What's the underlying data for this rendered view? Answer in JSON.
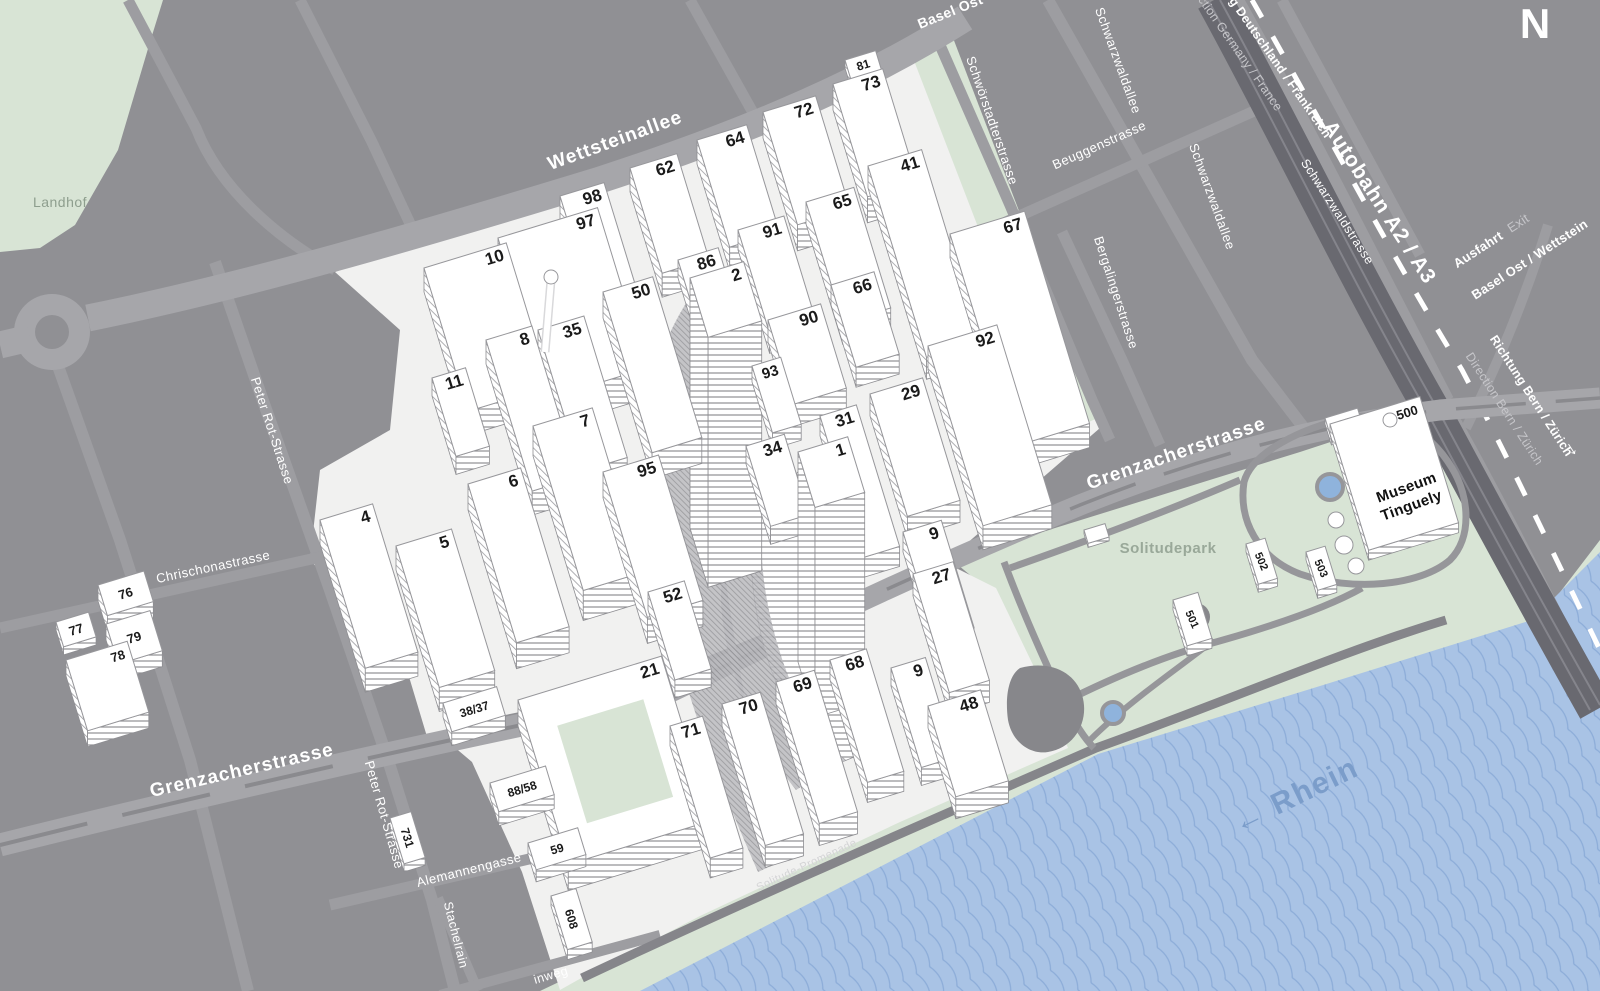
{
  "map": {
    "colors": {
      "background": "#909094",
      "road_major": "#a6a6aa",
      "road_minor": "#9d9da1",
      "road_median": "#8a8a8e",
      "autobahn": "#696970",
      "campus_ground": "#f1f1f0",
      "green_area": "#d8e4d5",
      "water": "#a9c3e5",
      "water_line": "#8cacd8",
      "water_label": "#7b9dca",
      "building_fill": "#ffffff",
      "building_edge": "#97979b",
      "building_number": "#1a1a1a",
      "street_label": "#ffffff",
      "muted_label": "#c6c6ca",
      "park_label": "#99a899",
      "park_path": "#96969a"
    },
    "compass": {
      "label": "N"
    },
    "street_labels": [
      {
        "text": "Wettsteinallee",
        "x": 617,
        "y": 146,
        "rot": -20,
        "size": 19,
        "color": "#ffffff",
        "weight": 600,
        "spacing": 1
      },
      {
        "text": "Grenzacherstrasse",
        "x": 243,
        "y": 776,
        "rot": -13,
        "size": 19,
        "color": "#ffffff",
        "weight": 600,
        "spacing": 1
      },
      {
        "text": "Grenzacherstrasse",
        "x": 1178,
        "y": 459,
        "rot": -19,
        "size": 19,
        "color": "#ffffff",
        "weight": 600,
        "spacing": 1
      },
      {
        "text": "Chrischonastrasse",
        "x": 214,
        "y": 571,
        "rot": -12,
        "size": 13,
        "color": "#ffffff",
        "weight": 400,
        "spacing": 0.5
      },
      {
        "text": "Peter Rot-Strasse",
        "x": 268,
        "y": 432,
        "rot": 72,
        "size": 13,
        "color": "#ffffff",
        "weight": 400,
        "spacing": 0.5
      },
      {
        "text": "Peter Rot-Strasse",
        "x": 380,
        "y": 816,
        "rot": 74,
        "size": 13,
        "color": "#ffffff",
        "weight": 400,
        "spacing": 0.5
      },
      {
        "text": "Alemannengasse",
        "x": 470,
        "y": 874,
        "rot": -14,
        "size": 13,
        "color": "#ffffff",
        "weight": 400,
        "spacing": 0.5
      },
      {
        "text": "Stachelrain",
        "x": 452,
        "y": 936,
        "rot": 76,
        "size": 12.5,
        "color": "#ffffff",
        "weight": 400,
        "spacing": 0.5
      },
      {
        "text": "inweg",
        "x": 552,
        "y": 979,
        "rot": -16,
        "size": 12.5,
        "color": "#ffffff",
        "weight": 400,
        "spacing": 0.5
      },
      {
        "text": "Schwörstadterstrasse",
        "x": 988,
        "y": 122,
        "rot": 71,
        "size": 13,
        "color": "#ffffff",
        "weight": 400,
        "spacing": 0.5
      },
      {
        "text": "Schwarzwaldallee",
        "x": 1114,
        "y": 62,
        "rot": 70,
        "size": 13,
        "color": "#ffffff",
        "weight": 400,
        "spacing": 0.5
      },
      {
        "text": "Schwarzwaldallee",
        "x": 1208,
        "y": 198,
        "rot": 70,
        "size": 13,
        "color": "#ffffff",
        "weight": 400,
        "spacing": 0.5
      },
      {
        "text": "Beuggenstrasse",
        "x": 1101,
        "y": 149,
        "rot": -24,
        "size": 13,
        "color": "#ffffff",
        "weight": 400,
        "spacing": 0.5
      },
      {
        "text": "Bergalingerstrasse",
        "x": 1112,
        "y": 294,
        "rot": 72,
        "size": 13,
        "color": "#ffffff",
        "weight": 400,
        "spacing": 0.5
      },
      {
        "text": "Schwarzwaldstrasse",
        "x": 1334,
        "y": 214,
        "rot": 57,
        "size": 12.5,
        "color": "#ffffff",
        "weight": 400,
        "spacing": 0.5
      },
      {
        "text": "Solitude-Promenade",
        "x": 808,
        "y": 868,
        "rot": -25,
        "size": 11,
        "color": "#d4d4d6",
        "weight": 400,
        "spacing": 0.5
      }
    ],
    "highway_labels": [
      {
        "text": "Autobahn A2 / A3",
        "x": 1374,
        "y": 206,
        "rot": 57,
        "size": 21,
        "color": "#ffffff",
        "weight": 600,
        "spacing": 1
      },
      {
        "text": "Richtung Deutschland / Frankreich",
        "x": 1263,
        "y": 50,
        "rot": 55,
        "size": 12.5,
        "color": "#ffffff",
        "weight": 700,
        "spacing": 0.3
      },
      {
        "text": "Direction Germany / France",
        "x": 1230,
        "y": 46,
        "rot": 55,
        "size": 12.5,
        "color": "#c6c6ca",
        "weight": 400,
        "spacing": 0.3
      },
      {
        "text": "Richtung Bern / Zürich",
        "x": 1528,
        "y": 398,
        "rot": 57,
        "size": 12.5,
        "color": "#ffffff",
        "weight": 700,
        "spacing": 0.3
      },
      {
        "text": "Direction Bern / Zürich",
        "x": 1501,
        "y": 411,
        "rot": 57,
        "size": 12.5,
        "color": "#c6c6ca",
        "weight": 400,
        "spacing": 0.3
      },
      {
        "text": "→",
        "x": 1569,
        "y": 451,
        "rot": 57,
        "size": 20,
        "color": "#ffffff",
        "weight": 700,
        "spacing": 0
      },
      {
        "text": "Ausfahrt",
        "x": 1504,
        "y": 238,
        "rot": -33,
        "size": 13,
        "color": "#ffffff",
        "weight": 700,
        "anchor": "end",
        "spacing": 0.3
      },
      {
        "text": "Exit",
        "x": 1511,
        "y": 233,
        "rot": -33,
        "size": 13,
        "color": "#c6c6ca",
        "weight": 400,
        "anchor": "start",
        "spacing": 0.3
      },
      {
        "text": "Basel Ost / Wettstein",
        "x": 1532,
        "y": 263,
        "rot": -33,
        "size": 13,
        "color": "#ffffff",
        "weight": 700,
        "spacing": 0.3
      },
      {
        "text": "Basel Ost",
        "x": 952,
        "y": 16,
        "rot": -22,
        "size": 14,
        "color": "#ffffff",
        "weight": 700,
        "spacing": 0.5
      }
    ],
    "area_labels": [
      {
        "text": "Landhof",
        "x": 60,
        "y": 207,
        "rot": 0,
        "size": 14,
        "color": "#8e9e8e",
        "weight": 400,
        "spacing": 0.5
      },
      {
        "text": "Solitudepark",
        "x": 1168,
        "y": 553,
        "rot": 0,
        "size": 15,
        "color": "#99a899",
        "weight": 700,
        "spacing": 0.5
      },
      {
        "text": "← Rhein",
        "x": 1300,
        "y": 804,
        "rot": -26,
        "size": 30,
        "color": "#7b9dca",
        "weight": 700,
        "spacing": 2
      },
      {
        "text": "Museum",
        "x": 1408,
        "y": 492,
        "rot": -20,
        "size": 15,
        "color": "#111111",
        "weight": 700,
        "spacing": 0
      },
      {
        "text": "Tinguely",
        "x": 1413,
        "y": 510,
        "rot": -20,
        "size": 15,
        "color": "#111111",
        "weight": 700,
        "spacing": 0
      }
    ],
    "buildings": [
      {
        "l": "10",
        "x": 424,
        "y": 268,
        "w": 86,
        "h": 150,
        "d": 24
      },
      {
        "l": "97",
        "x": 498,
        "y": 238,
        "w": 104,
        "h": 168,
        "d": 30
      },
      {
        "l": "98",
        "x": 560,
        "y": 196,
        "w": 46,
        "h": 122,
        "d": 26
      },
      {
        "l": "62",
        "x": 630,
        "y": 168,
        "w": 49,
        "h": 110,
        "d": 24
      },
      {
        "l": "64",
        "x": 697,
        "y": 140,
        "w": 52,
        "h": 112,
        "d": 24
      },
      {
        "l": "72",
        "x": 763,
        "y": 112,
        "w": 55,
        "h": 118,
        "d": 26
      },
      {
        "l": "73",
        "x": 833,
        "y": 84,
        "w": 52,
        "h": 118,
        "d": 26
      },
      {
        "l": "81",
        "x": 845,
        "y": 60,
        "w": 32,
        "h": 20,
        "d": 8,
        "fs": 12,
        "la": "c"
      },
      {
        "l": "41",
        "x": 868,
        "y": 166,
        "w": 56,
        "h": 200,
        "d": 22
      },
      {
        "l": "65",
        "x": 806,
        "y": 202,
        "w": 50,
        "h": 126,
        "d": 22
      },
      {
        "l": "67",
        "x": 950,
        "y": 234,
        "w": 78,
        "h": 222,
        "d": 24
      },
      {
        "l": "91",
        "x": 738,
        "y": 230,
        "w": 48,
        "h": 108,
        "d": 20
      },
      {
        "l": "86",
        "x": 678,
        "y": 260,
        "w": 42,
        "h": 86,
        "d": 18
      },
      {
        "l": "66",
        "x": 831,
        "y": 285,
        "w": 45,
        "h": 86,
        "d": 20
      },
      {
        "l": "90",
        "x": 768,
        "y": 320,
        "w": 55,
        "h": 88,
        "d": 22
      },
      {
        "l": "93",
        "x": 752,
        "y": 366,
        "w": 30,
        "h": 70,
        "d": 16,
        "fs": 15
      },
      {
        "l": "92",
        "x": 928,
        "y": 346,
        "w": 72,
        "h": 188,
        "d": 24
      },
      {
        "l": "29",
        "x": 870,
        "y": 394,
        "w": 55,
        "h": 128,
        "d": 22
      },
      {
        "l": "31",
        "x": 820,
        "y": 416,
        "w": 38,
        "h": 148,
        "d": 20
      },
      {
        "l": "34",
        "x": 746,
        "y": 446,
        "w": 40,
        "h": 84,
        "d": 18
      },
      {
        "l": "35",
        "x": 538,
        "y": 330,
        "w": 48,
        "h": 148,
        "d": 24
      },
      {
        "l": "8",
        "x": 486,
        "y": 340,
        "w": 48,
        "h": 158,
        "d": 24
      },
      {
        "l": "50",
        "x": 603,
        "y": 292,
        "w": 52,
        "h": 168,
        "d": 26
      },
      {
        "l": "11",
        "x": 432,
        "y": 378,
        "w": 35,
        "h": 82,
        "d": 18
      },
      {
        "l": "7",
        "x": 533,
        "y": 426,
        "w": 62,
        "h": 172,
        "d": 30
      },
      {
        "l": "6",
        "x": 468,
        "y": 484,
        "w": 55,
        "h": 166,
        "d": 26
      },
      {
        "l": "95",
        "x": 603,
        "y": 472,
        "w": 58,
        "h": 152,
        "d": 26
      },
      {
        "l": "5",
        "x": 396,
        "y": 546,
        "w": 58,
        "h": 148,
        "d": 24
      },
      {
        "l": "4",
        "x": 320,
        "y": 520,
        "w": 55,
        "h": 155,
        "d": 24
      },
      {
        "l": "52",
        "x": 648,
        "y": 592,
        "w": 38,
        "h": 92,
        "d": 18
      },
      {
        "l": "9",
        "x": 903,
        "y": 532,
        "w": 40,
        "h": 112,
        "d": 20
      },
      {
        "l": "27",
        "x": 913,
        "y": 574,
        "w": 42,
        "h": 124,
        "d": 22
      },
      {
        "l": "21",
        "x": 518,
        "y": 700,
        "w": 150,
        "h": 172,
        "d": 26,
        "courtyard": true
      },
      {
        "l": "71",
        "x": 670,
        "y": 726,
        "w": 34,
        "h": 138,
        "d": 20
      },
      {
        "l": "70",
        "x": 722,
        "y": 704,
        "w": 40,
        "h": 148,
        "d": 22
      },
      {
        "l": "69",
        "x": 776,
        "y": 682,
        "w": 40,
        "h": 148,
        "d": 22
      },
      {
        "l": "68",
        "x": 830,
        "y": 660,
        "w": 38,
        "h": 128,
        "d": 20
      },
      {
        "l": "9",
        "x": 891,
        "y": 668,
        "w": 36,
        "h": 104,
        "d": 18
      },
      {
        "l": "48",
        "x": 928,
        "y": 706,
        "w": 55,
        "h": 95,
        "d": 22
      },
      {
        "l": "38/37",
        "x": 443,
        "y": 703,
        "w": 56,
        "h": 30,
        "d": 14,
        "fs": 12,
        "la": "c"
      },
      {
        "l": "88/58",
        "x": 490,
        "y": 783,
        "w": 58,
        "h": 30,
        "d": 14,
        "fs": 12,
        "la": "c"
      },
      {
        "l": "59",
        "x": 528,
        "y": 843,
        "w": 52,
        "h": 28,
        "d": 12,
        "fs": 12,
        "la": "c"
      },
      {
        "l": "608",
        "x": 551,
        "y": 896,
        "w": 26,
        "h": 56,
        "d": 10,
        "fs": 12,
        "lr": 73,
        "la": "c"
      },
      {
        "l": "731",
        "x": 390,
        "y": 818,
        "w": 22,
        "h": 48,
        "d": 8,
        "fs": 12,
        "lr": 73,
        "la": "c"
      },
      {
        "l": "76",
        "x": 98,
        "y": 585,
        "w": 48,
        "h": 32,
        "d": 16,
        "fs": 13,
        "la": "c"
      },
      {
        "l": "77",
        "x": 56,
        "y": 622,
        "w": 34,
        "h": 26,
        "d": 8,
        "fs": 13,
        "la": "c"
      },
      {
        "l": "79",
        "x": 106,
        "y": 624,
        "w": 46,
        "h": 42,
        "d": 16,
        "fs": 13,
        "la": "c"
      },
      {
        "l": "78",
        "x": 66,
        "y": 660,
        "w": 64,
        "h": 74,
        "d": 16,
        "fs": 13
      },
      {
        "l": "500",
        "x": 1330,
        "y": 424,
        "w": 94,
        "h": 132,
        "d": 10,
        "fs": 13
      },
      {
        "l": "80",
        "x": 1325,
        "y": 418,
        "w": 34,
        "h": 22,
        "d": 6,
        "fs": 12,
        "la": "c"
      },
      {
        "l": "502",
        "x": 1246,
        "y": 544,
        "w": 20,
        "h": 42,
        "d": 8,
        "fs": 11,
        "lr": 66,
        "la": "c"
      },
      {
        "l": "503",
        "x": 1306,
        "y": 552,
        "w": 20,
        "h": 40,
        "d": 8,
        "fs": 11,
        "lr": 66,
        "la": "c"
      },
      {
        "l": "501",
        "x": 1173,
        "y": 600,
        "w": 26,
        "h": 48,
        "d": 10,
        "fs": 11,
        "lr": 66,
        "la": "c"
      },
      {
        "l": "",
        "x": 1084,
        "y": 530,
        "w": 22,
        "h": 14,
        "d": 4,
        "la": "c"
      },
      {
        "l": "2",
        "x": 690,
        "y": 278,
        "w": 56,
        "h": 62,
        "d": 250,
        "tower": true
      },
      {
        "l": "1",
        "x": 798,
        "y": 452,
        "w": 52,
        "h": 58,
        "d": 210,
        "tower": true
      }
    ]
  }
}
